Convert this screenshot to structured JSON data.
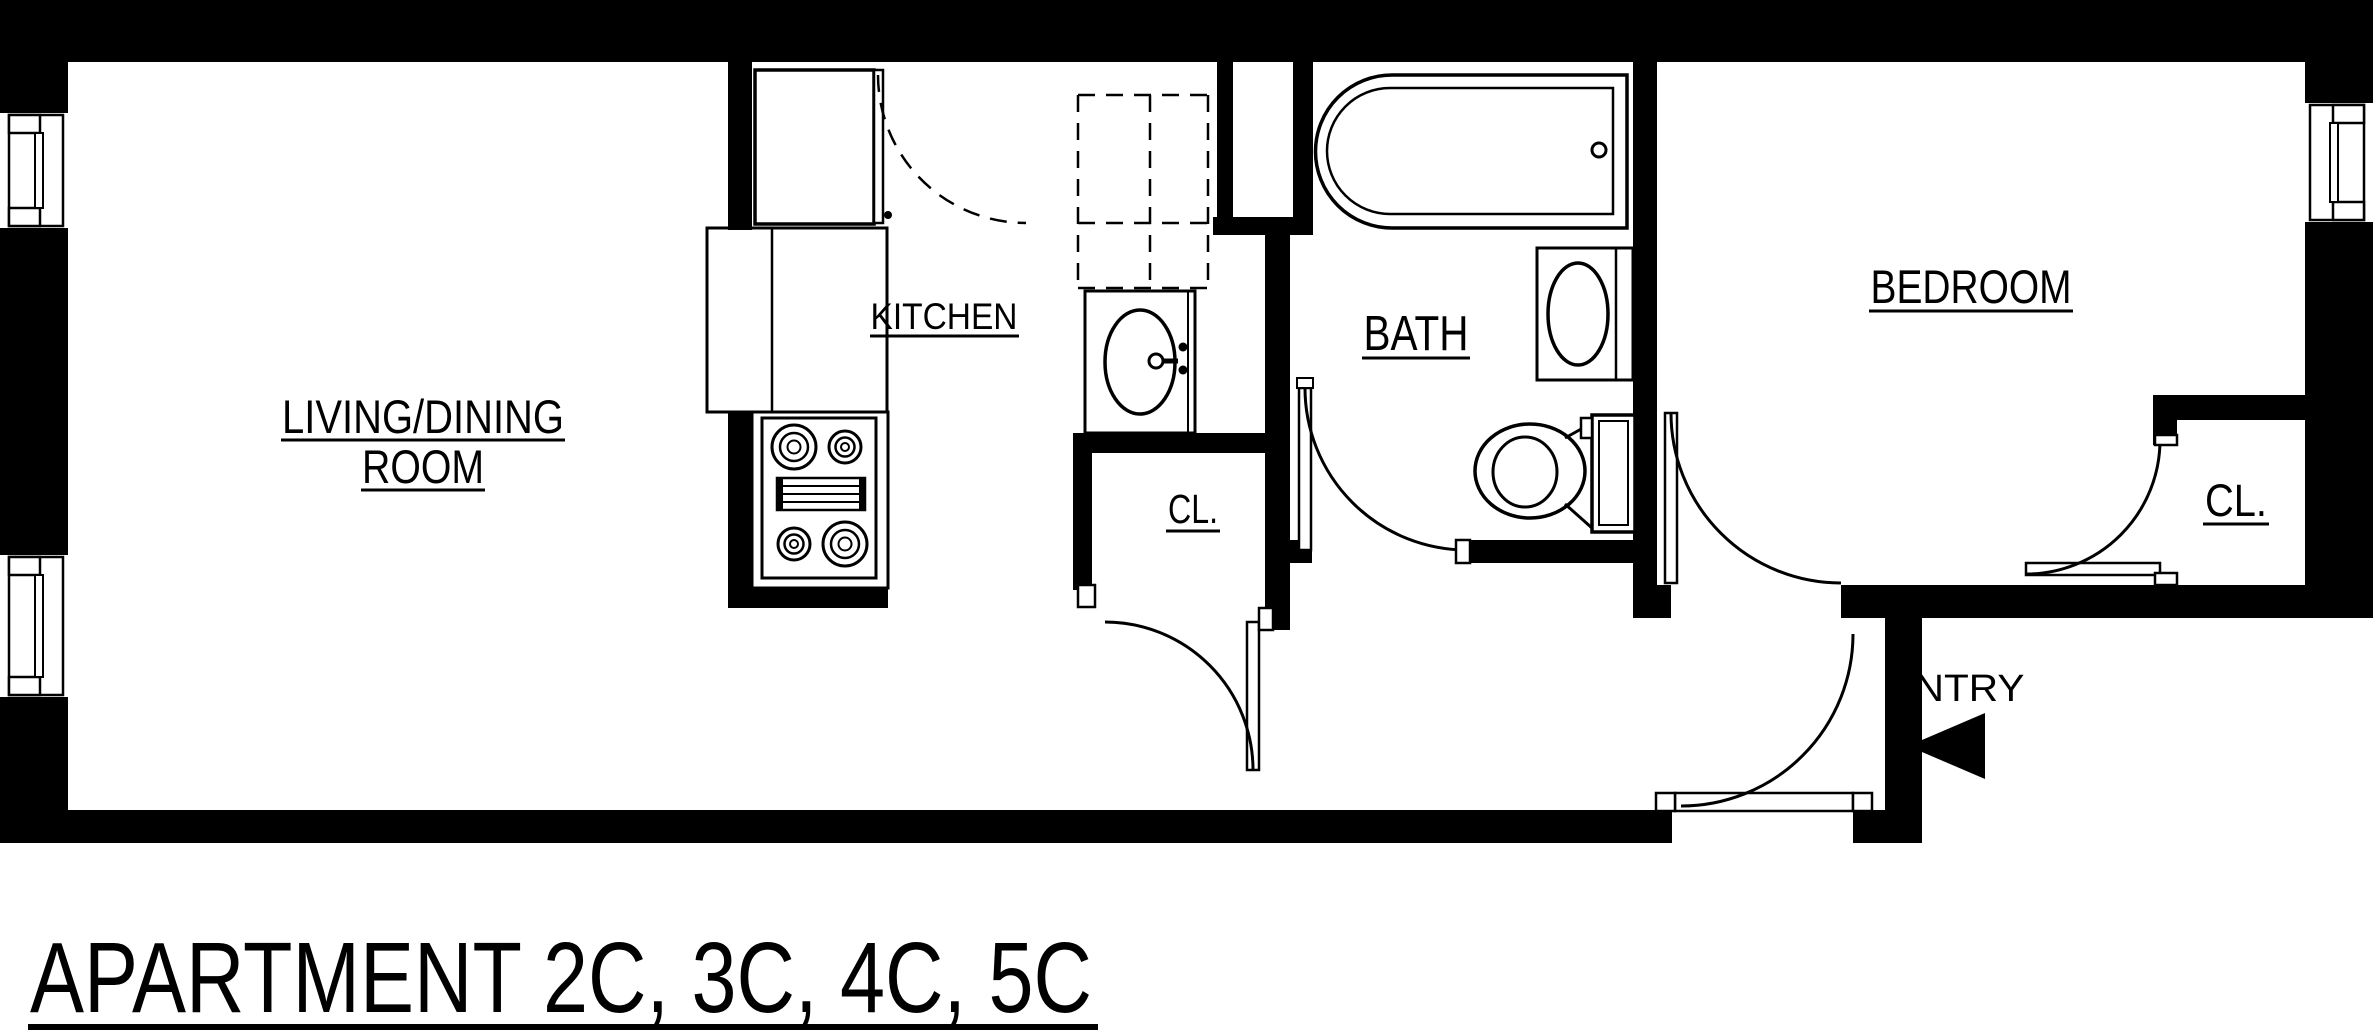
{
  "meta": {
    "type": "architectural-floor-plan",
    "background_color": "#ffffff",
    "line_color": "#000000"
  },
  "title": {
    "text": "APARTMENT 2C, 3C, 4C, 5C"
  },
  "rooms": {
    "living": {
      "line1": "LIVING/DINING",
      "line2": "ROOM"
    },
    "kitchen": {
      "label": "KITCHEN"
    },
    "kitchen_closet": {
      "label": "CL."
    },
    "bath": {
      "label": "BATH"
    },
    "bedroom": {
      "label": "BEDROOM"
    },
    "bedroom_closet": {
      "label": "CL."
    },
    "entry": {
      "label": "ENTRY"
    }
  },
  "fixtures": [
    "refrigerator with swing arc",
    "base counter",
    "range with four burners and griddle",
    "kitchen sink with faucet",
    "dashed upper cabinets",
    "bathtub with drain",
    "bathroom vanity sink",
    "toilet with tank",
    "three windows",
    "six door swings",
    "entry direction arrow"
  ]
}
